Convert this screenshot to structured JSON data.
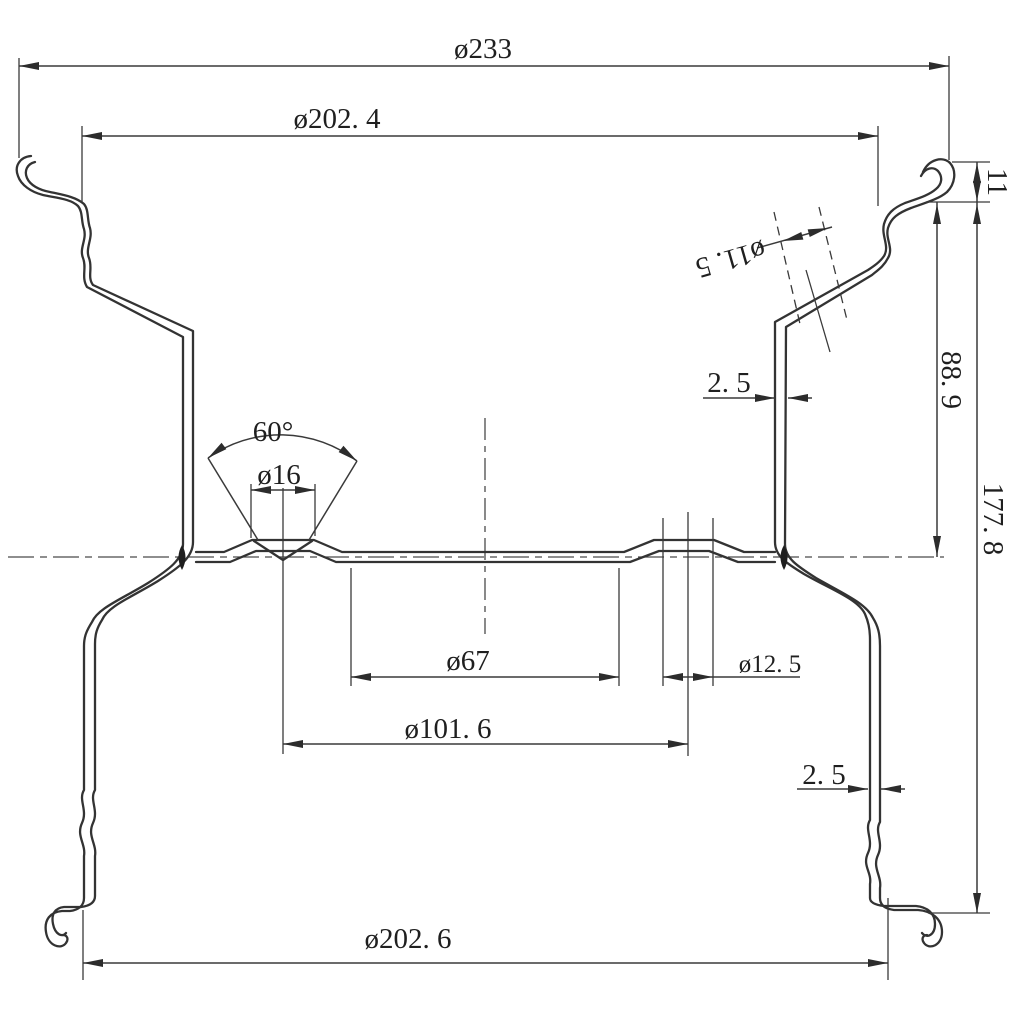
{
  "drawing": {
    "title": "wheel-rim-cross-section",
    "line_color": "#333333",
    "text_color": "#1f1f1f",
    "background": "#ffffff",
    "labels": {
      "overall_diameter": "ø233",
      "top_bead_diameter": "ø202. 4",
      "flange_height": "11",
      "upper_section_height": "88. 9",
      "overall_height": "177. 8",
      "valve_hole_diameter": "ø11. 5",
      "upper_wall_thickness": "2. 5",
      "countersink_angle": "60°",
      "lug_hole_diameter": "ø16",
      "center_bore_diameter": "ø67",
      "bolt_circle_diameter": "ø101. 6",
      "pilot_hole_diameter": "ø12. 5",
      "lower_wall_thickness": "2. 5",
      "bottom_bead_diameter": "ø202. 6"
    }
  }
}
